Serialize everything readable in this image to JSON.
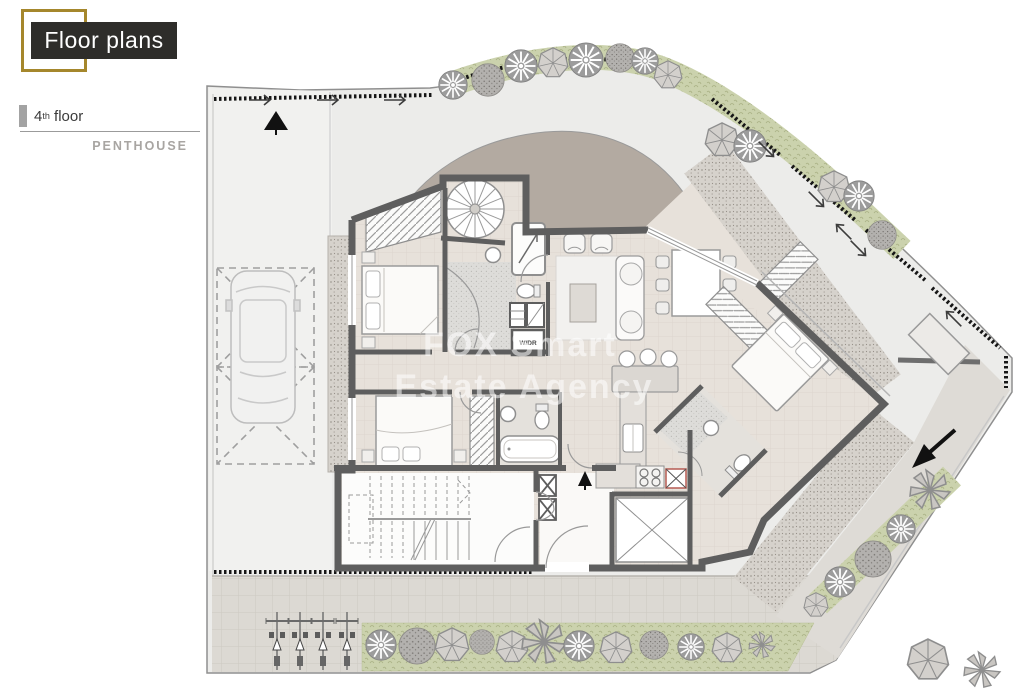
{
  "header": {
    "title": "Floor plans",
    "floor_number": "4",
    "floor_ordinal": "th",
    "floor_word": "floor",
    "subtitle": "PENTHOUSE"
  },
  "watermark": {
    "line1": "FOX Smart",
    "line2": "Estate Agency"
  },
  "plan_labels": {
    "laundry_closet": "W/DR"
  },
  "colors": {
    "accent_gold": "#a5872c",
    "title_bg": "#2e2d2a",
    "wall": "#5e5e5e",
    "floor_tile": "#e7e1da",
    "terrace": "#ececea",
    "roof_deck": "#b3aaa1",
    "gravel": "#d8d4cf",
    "grass": "#cbd2ad",
    "pavement": "#dcd9d3",
    "tree_gray": "#9c9c9c",
    "watermark": "rgba(255,255,255,0.55)"
  },
  "site": {
    "trees": [
      {
        "type": "flake",
        "x": 453,
        "y": 85,
        "r": 15
      },
      {
        "type": "dot",
        "x": 488,
        "y": 80,
        "r": 17
      },
      {
        "type": "flake",
        "x": 521,
        "y": 66,
        "r": 17
      },
      {
        "type": "poly",
        "x": 553,
        "y": 63,
        "r": 16
      },
      {
        "type": "flake",
        "x": 586,
        "y": 60,
        "r": 18
      },
      {
        "type": "dot",
        "x": 620,
        "y": 58,
        "r": 15
      },
      {
        "type": "flake",
        "x": 645,
        "y": 61,
        "r": 14
      },
      {
        "type": "poly",
        "x": 668,
        "y": 75,
        "r": 15
      },
      {
        "type": "poly",
        "x": 722,
        "y": 140,
        "r": 18
      },
      {
        "type": "flake",
        "x": 750,
        "y": 146,
        "r": 17
      },
      {
        "type": "poly",
        "x": 834,
        "y": 187,
        "r": 17
      },
      {
        "type": "flake",
        "x": 859,
        "y": 196,
        "r": 16
      },
      {
        "type": "dot",
        "x": 882,
        "y": 235,
        "r": 15
      },
      {
        "type": "fan",
        "x": 930,
        "y": 490,
        "r": 20
      },
      {
        "type": "flake",
        "x": 901,
        "y": 529,
        "r": 15
      },
      {
        "type": "dot",
        "x": 873,
        "y": 559,
        "r": 19
      },
      {
        "type": "flake",
        "x": 840,
        "y": 582,
        "r": 16
      },
      {
        "type": "poly",
        "x": 816,
        "y": 605,
        "r": 13
      },
      {
        "type": "flake",
        "x": 381,
        "y": 645,
        "r": 16
      },
      {
        "type": "dot",
        "x": 417,
        "y": 646,
        "r": 19
      },
      {
        "type": "poly",
        "x": 452,
        "y": 645,
        "r": 18
      },
      {
        "type": "dot",
        "x": 482,
        "y": 642,
        "r": 13
      },
      {
        "type": "poly",
        "x": 512,
        "y": 647,
        "r": 17
      },
      {
        "type": "fan",
        "x": 544,
        "y": 642,
        "r": 22
      },
      {
        "type": "flake",
        "x": 579,
        "y": 646,
        "r": 16
      },
      {
        "type": "poly",
        "x": 616,
        "y": 648,
        "r": 17
      },
      {
        "type": "dot",
        "x": 654,
        "y": 645,
        "r": 15
      },
      {
        "type": "flake",
        "x": 691,
        "y": 647,
        "r": 14
      },
      {
        "type": "poly",
        "x": 727,
        "y": 648,
        "r": 16
      },
      {
        "type": "fan",
        "x": 762,
        "y": 645,
        "r": 13
      },
      {
        "type": "poly",
        "x": 928,
        "y": 660,
        "r": 22
      },
      {
        "type": "fan",
        "x": 982,
        "y": 670,
        "r": 18
      }
    ],
    "lamps": [
      {
        "x": 277,
        "y": 612
      },
      {
        "x": 300,
        "y": 612
      },
      {
        "x": 323,
        "y": 612
      },
      {
        "x": 347,
        "y": 612
      }
    ],
    "arrows": [
      {
        "x": 265,
        "y": 100,
        "deg": 0
      },
      {
        "x": 333,
        "y": 100,
        "deg": 0
      },
      {
        "x": 400,
        "y": 100,
        "deg": 0
      },
      {
        "x": 770,
        "y": 153,
        "deg": 45
      },
      {
        "x": 820,
        "y": 203,
        "deg": 45
      },
      {
        "x": 840,
        "y": 228,
        "deg": 225
      },
      {
        "x": 862,
        "y": 252,
        "deg": 45
      },
      {
        "x": 950,
        "y": 315,
        "deg": 225
      }
    ]
  }
}
